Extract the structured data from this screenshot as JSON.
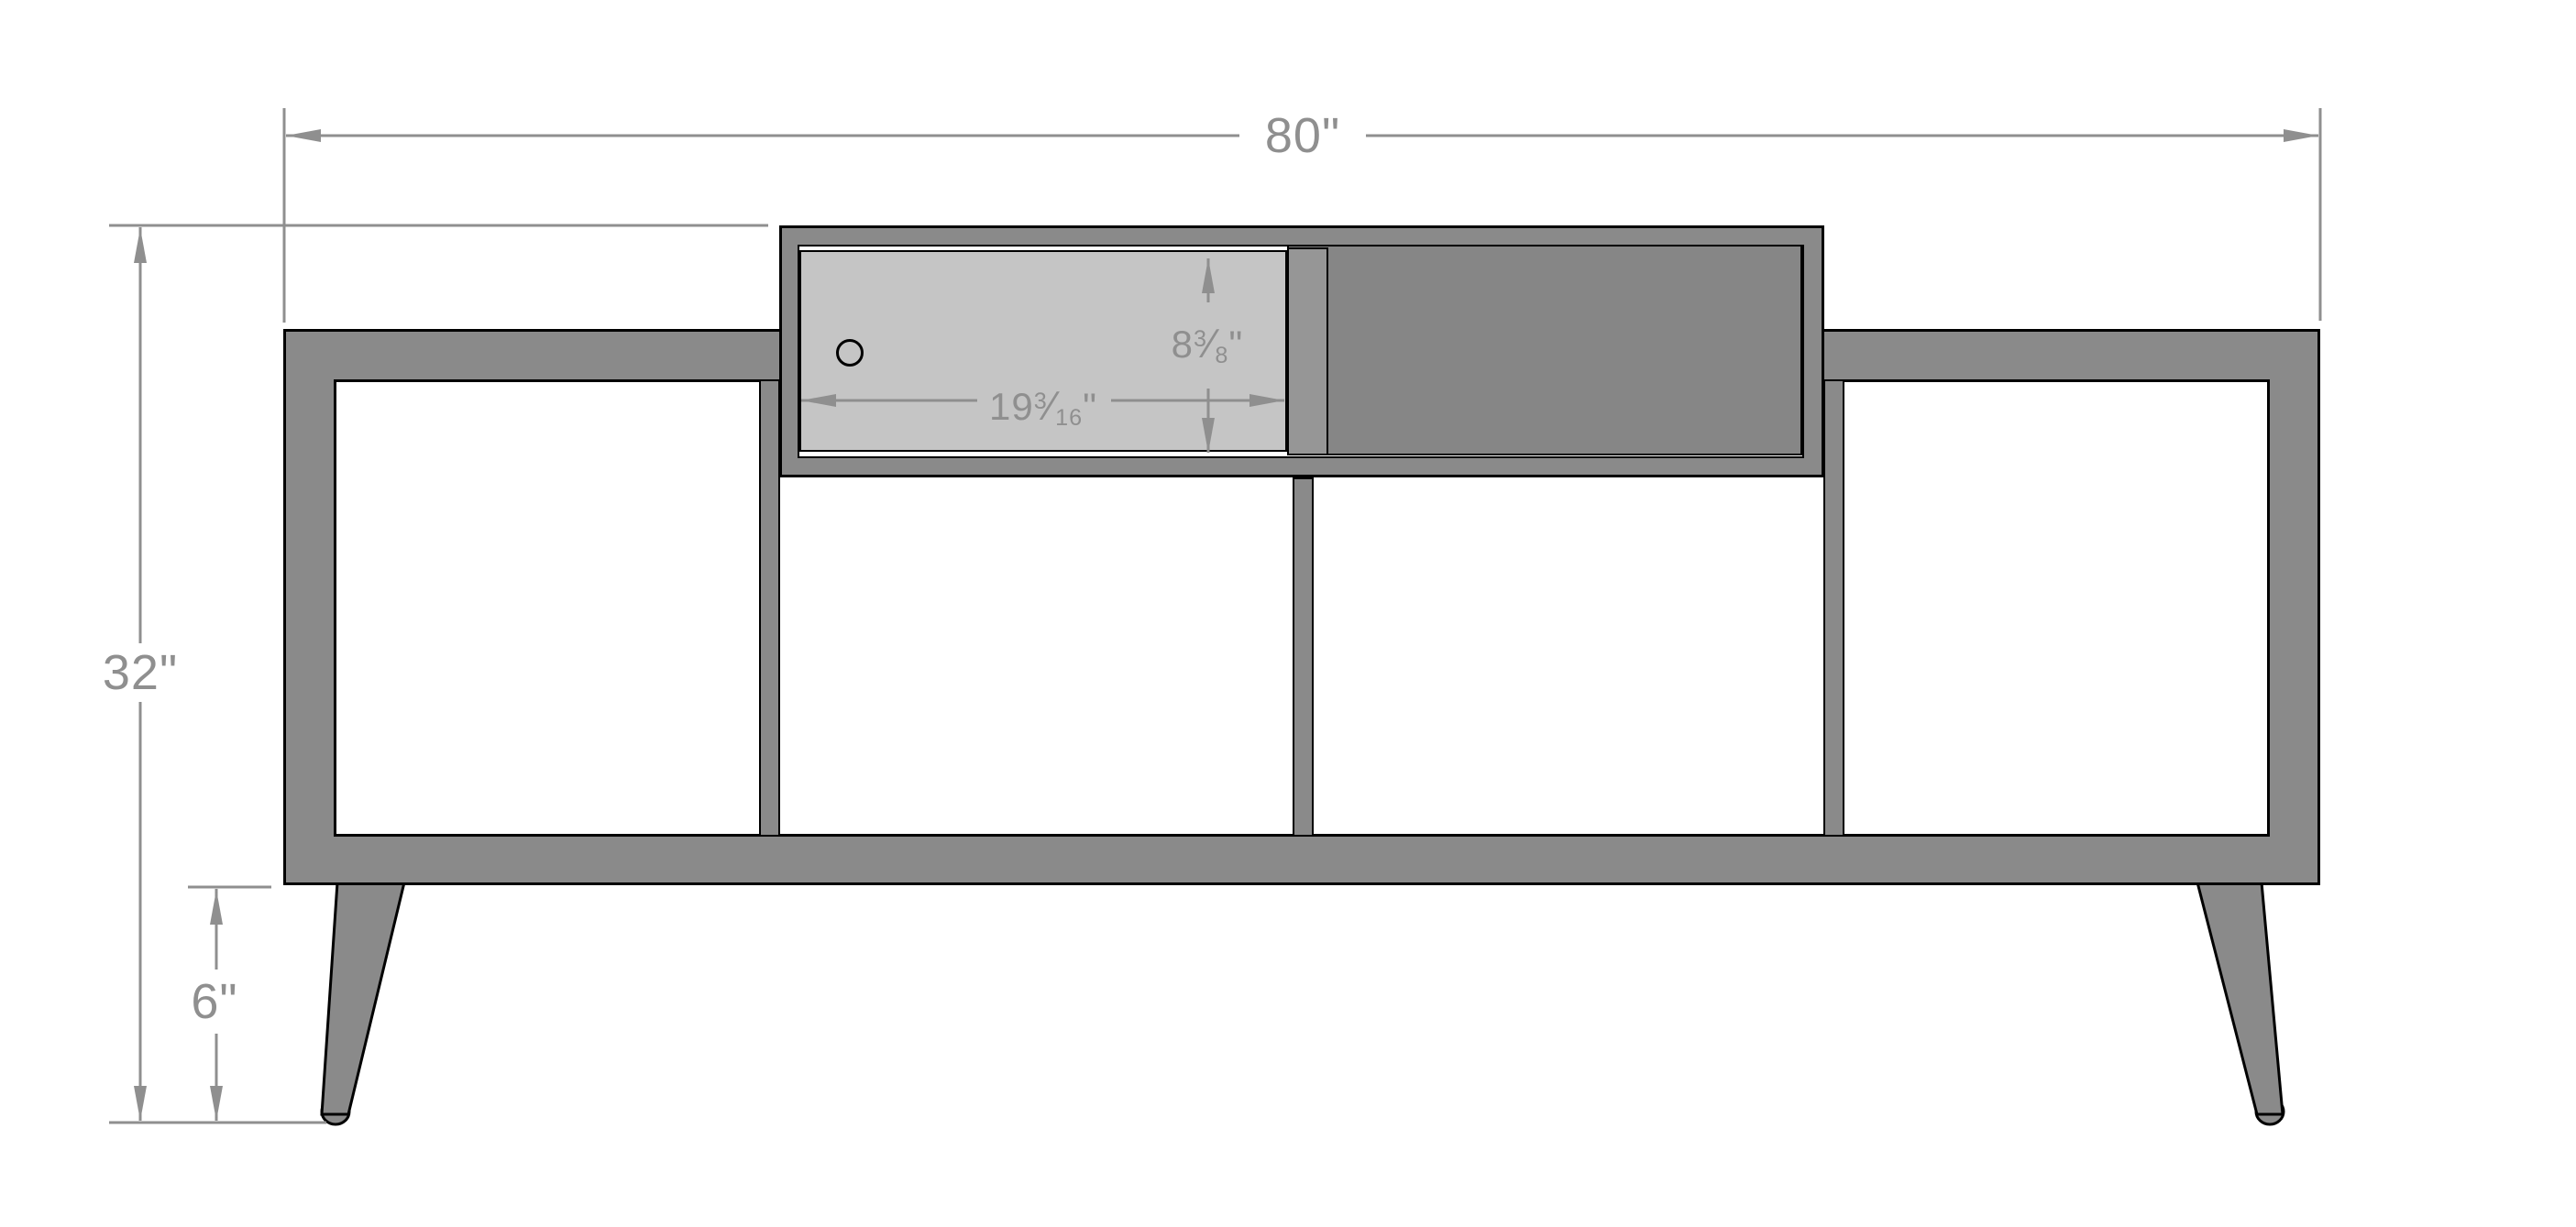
{
  "drawing": {
    "kind": "furniture dimension elevation",
    "dimensions": {
      "overall_width_label": "80\"",
      "overall_height_label": "32\"",
      "leg_height_label": "6\"",
      "door_width": {
        "whole": "19",
        "num": "3",
        "slash": "⁄",
        "den": "16",
        "unit": "\""
      },
      "door_height": {
        "whole": "8",
        "num": "3",
        "slash": "⁄",
        "den": "8",
        "unit": "\""
      }
    },
    "colors": {
      "background": "#ffffff",
      "body_gray": "#8a8a8a",
      "dark_door_gray": "#868686",
      "door_stile_gray": "#969696",
      "light_door_gray": "#c5c5c5",
      "outline_black": "#000000",
      "dimension_gray": "#8f8f8f"
    }
  }
}
